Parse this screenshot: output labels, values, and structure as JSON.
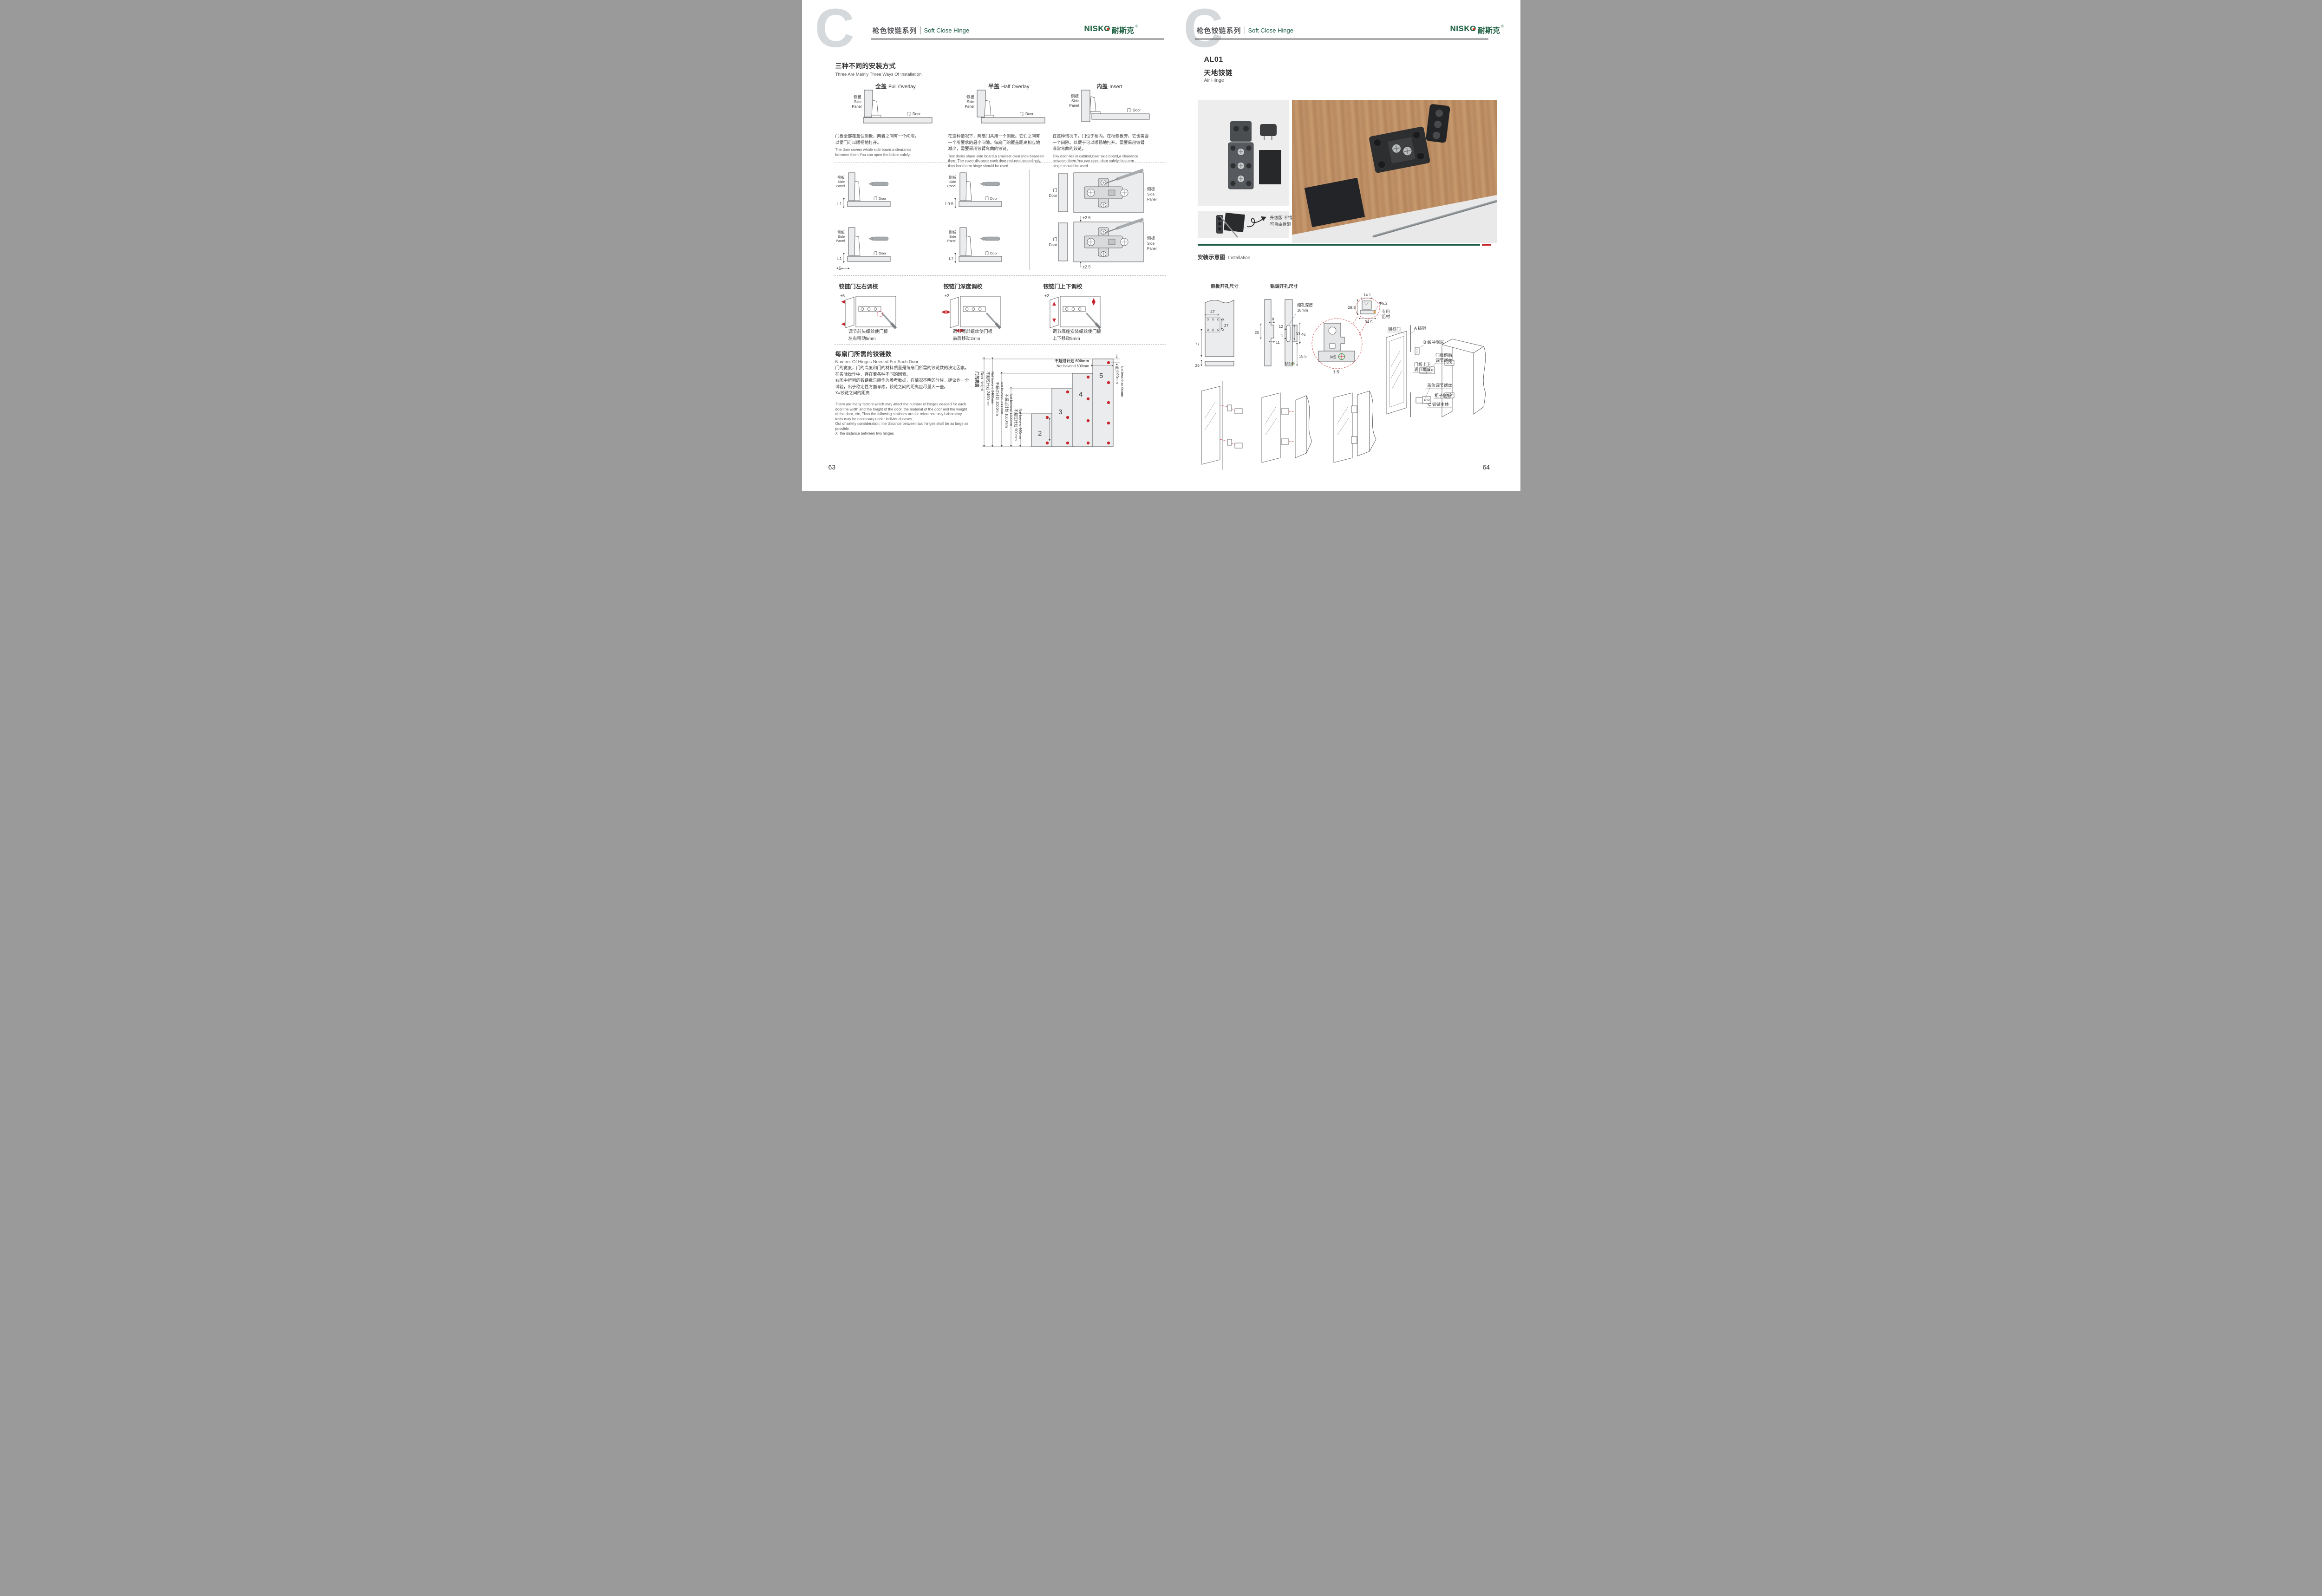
{
  "common": {
    "side_panel_cn": "侧板",
    "side_en1": "Side",
    "side_en2": "Panel",
    "door_cn": "门",
    "door_en": "Door"
  },
  "header": {
    "watermark": "C",
    "series_cn": "枪色铰链系列",
    "series_en": "Soft Close Hinge",
    "logo_text": "NISKO",
    "logo_cn": "耐斯克",
    "logo_reg": "®"
  },
  "colors": {
    "brand_green": "#1d5c45",
    "logo_green": "#175c3c",
    "accent_red": "#c8242b",
    "bar_red": "#c1272d"
  },
  "left": {
    "page_number": "63",
    "section1": {
      "title_cn": "三种不同的安装方式",
      "title_en": "Three Are Mainly Three Ways Of Installation",
      "items": [
        {
          "name_cn": "全盖",
          "name_en": "Full Overlay",
          "desc_cn": "门板全部覆盖住侧板，两者之间有一个间隙，\n以便门可以顺畅地打开。",
          "desc_en": "The door covers whole side board,a clearance\nbetween them,You can open the bdoor safely."
        },
        {
          "name_cn": "半盖",
          "name_en": "Half Overlay",
          "desc_cn": "在这种情况下，两扇门共用一个侧板。它们之间有\n一个所要求的最小间隙。每扇门的覆盖距离相应地\n减少，需要采用铰臂弯曲的铰链。",
          "desc_en": "Tow doors share side board,a smallest clearance between\nthem,The cover distance each door reduces accordingly,\nthus bend arm hinge should be used."
        },
        {
          "name_cn": "内盖",
          "name_en": "Insert",
          "desc_cn": "在这种情况下，门位于柜内，在柜侧板旁。它也需要\n一个间隙。以便于可以顺畅地打开。需要采用铰臂\n非常弯曲的铰链。",
          "desc_en": "Tow door lies in cabinet,near side board,a clearance\nbetween them.You can open door safely,thus arm\nhinge should be used."
        }
      ]
    },
    "section2": {
      "cells": [
        {
          "dim": "L1"
        },
        {
          "dim": "L0.5"
        },
        {
          "dim": "L1",
          "dim2": "+5"
        },
        {
          "dim": "L7"
        }
      ],
      "plate_dim_top": "±2.5",
      "plate_dim_bottom": "±2.5"
    },
    "section3": {
      "items": [
        {
          "title": "铰链门左右调校",
          "tol": "±5",
          "cap1": "调节前头螺丝使门板",
          "cap2": "左右移动5mm"
        },
        {
          "title": "铰链门深度调校",
          "tol": "±2",
          "cap1": "调节尾部螺丝使门板",
          "cap2": "前后移动2mm"
        },
        {
          "title": "铰链门上下调校",
          "tol": "±2",
          "cap1": "调节底座安装螺丝使门板",
          "cap2": "上下移动5mm"
        }
      ]
    },
    "section4": {
      "title_cn": "每扇门所需的铰链数",
      "title_en": "Number Of Hinges Needed For Each Door",
      "desc_cn": "门的宽度，门的高度和门的材料质量是每扇门所需的铰链数的决定因素。\n在实际操作中，存在着各种不同的因素。\n右图中所列的铰链数只能作为参考数据，在情况不明的时候，建议作一个\n试验，出于稳定性方面考虑，铰链之间的距离应尽量大一些。\nX=铰链之间的距离",
      "desc_en": "There are many factors which may affect the number of hinges needed for each\ndoor.the width and the height of the door, the material of the door and the weight\nof the door, etc, Thus the following statistics are for reference only.Laboratory\ntests may be necessary under individual cases.\nOut of safety consideration, the distance between two hinges shall be as large as\npossible.\nX=the distance between two hinges",
      "chart": {
        "type": "bar",
        "axis_cn": "门的高度",
        "axis_en": "Door height",
        "door_width_cn": "不超过计划 600mm",
        "door_width_en": "Not bevond 600mm",
        "edge_cn": "至少90mm",
        "edge_en": "Not less than 90mm",
        "bars": [
          {
            "hinges": "2",
            "hinge_count": 2,
            "max_height_mm": 900,
            "limit_cn": "不超过计划 900mm",
            "limit_en": "Not bevond 900mm"
          },
          {
            "hinges": "3",
            "hinge_count": 3,
            "max_height_mm": 1600,
            "limit_cn": "不超过计划 1600mm",
            "limit_en": "Not bevond 1600mm"
          },
          {
            "hinges": "4",
            "hinge_count": 4,
            "max_height_mm": 2000,
            "limit_cn": "不超过计划 2000mm",
            "limit_en": "Not bevond 2000mm"
          },
          {
            "hinges": "5",
            "hinge_count": 5,
            "max_height_mm": 2400,
            "limit_cn": "不超过计划 2400mm",
            "limit_en": "Not bevond 2400mm"
          }
        ]
      }
    }
  },
  "right": {
    "page_number": "64",
    "product": {
      "code": "AL01",
      "name_cn": "天地铰链",
      "name_en": "Air Hinge"
    },
    "photo_note": "升级版·不锈钢轴心\n可自由拆卸",
    "installation": {
      "label_cn": "安装示意图",
      "label_en": "Installation"
    },
    "drill": {
      "side_title": "侧板开孔尺寸",
      "alu_title": "铝调开孔尺寸",
      "d47": "47",
      "d27": "27",
      "d77": "77",
      "d25": "25",
      "d8": "8",
      "d20": "20",
      "d11": "11",
      "d12": "12",
      "d1": "1",
      "d33": "33",
      "d46": "46",
      "d155": "15.5",
      "m5": "M5",
      "slot1": "槽孔深度",
      "slot2": "18mm",
      "d141": "14.1",
      "d289": "28.9",
      "d349": "34.9",
      "dia": "Φ6.2",
      "alu1": "专用",
      "alu2": "铝材",
      "scale": "1:5",
      "m5b": "M5"
    },
    "exploded": {
      "alu_door": "铝框门",
      "pin": "A 插销",
      "damper": "B 缓冲阻尼",
      "fb1": "门板前后",
      "fb2": "调节螺丝",
      "ud1": "门板上下",
      "ud2": "调节螺丝",
      "cover": "盖位调节螺丝",
      "cabinet": "柜子侧板",
      "body": "C 铰链主体"
    }
  }
}
